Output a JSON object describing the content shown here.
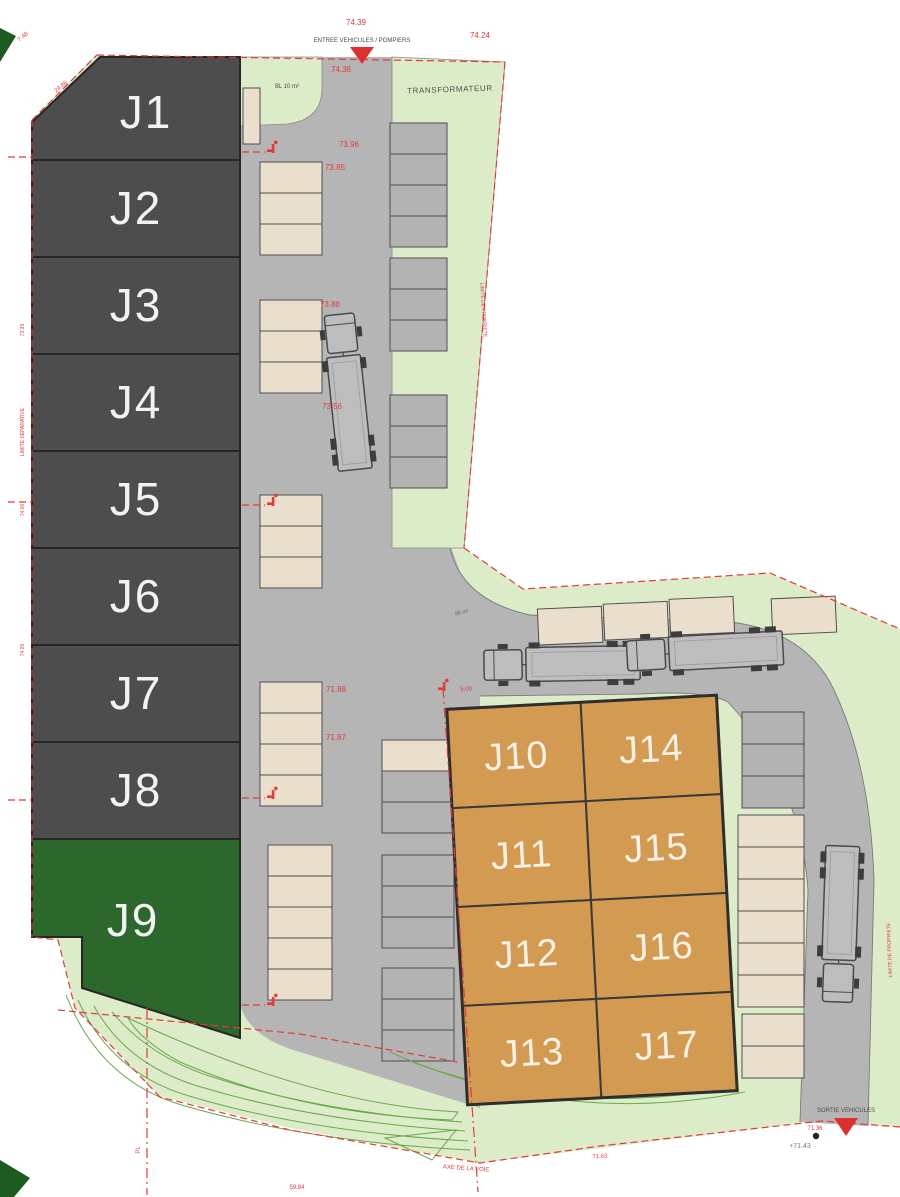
{
  "title": "Plan de masse - lotissement plots J1 a J17",
  "colors": {
    "plot_gray": "#4d4d4d",
    "plot_green": "#2c672c",
    "plot_orange": "#d39a52",
    "road_gray": "#b5b5b5",
    "parcel_green": "#ddecc8",
    "stall_beige": "#eadfcd",
    "annotation_red": "#e23b3b",
    "contour_green": "#6aa84f"
  },
  "plots": {
    "left": [
      {
        "id": "J1"
      },
      {
        "id": "J2"
      },
      {
        "id": "J3"
      },
      {
        "id": "J4"
      },
      {
        "id": "J5"
      },
      {
        "id": "J6"
      },
      {
        "id": "J7"
      },
      {
        "id": "J8"
      }
    ],
    "green": {
      "id": "J9"
    },
    "grid_left": [
      {
        "id": "J10"
      },
      {
        "id": "J11"
      },
      {
        "id": "J12"
      },
      {
        "id": "J13"
      }
    ],
    "grid_right": [
      {
        "id": "J14"
      },
      {
        "id": "J15"
      },
      {
        "id": "J16"
      },
      {
        "id": "J17"
      }
    ]
  },
  "labels": {
    "transformer": "TRANSFORMATEUR",
    "bin_store": "BL 10 m²",
    "entry": "ENTREE VEHICULES / POMPIERS",
    "exit": "SORTIE VEHICULES",
    "axis": "AXE DE LA VOIE",
    "sep_limit": "LIMITE SEPARATIVE",
    "prop_limit": "LIMITE DE PROPRIETE",
    "noue": "96 m²"
  },
  "levels": {
    "entry_top": "74.39",
    "entry_bottom": "74.38",
    "ne_corner": "74.24",
    "road_a": "73.96",
    "road_b": "73.85",
    "road_c": "73.88",
    "road_d": "73.56",
    "yard_a": "71.88",
    "yard_b": "71.87",
    "junction_dim": "5.00",
    "exit_level": "71.36",
    "exit_ground": "+71.43",
    "bottom_a": "71.63",
    "bottom_b": "59.84",
    "bevel_dim": "24.86",
    "nw_dim": "7.48",
    "left_a": "73.35",
    "left_b": "74.00",
    "left_c": "74.05",
    "pl_mark": "PL"
  }
}
